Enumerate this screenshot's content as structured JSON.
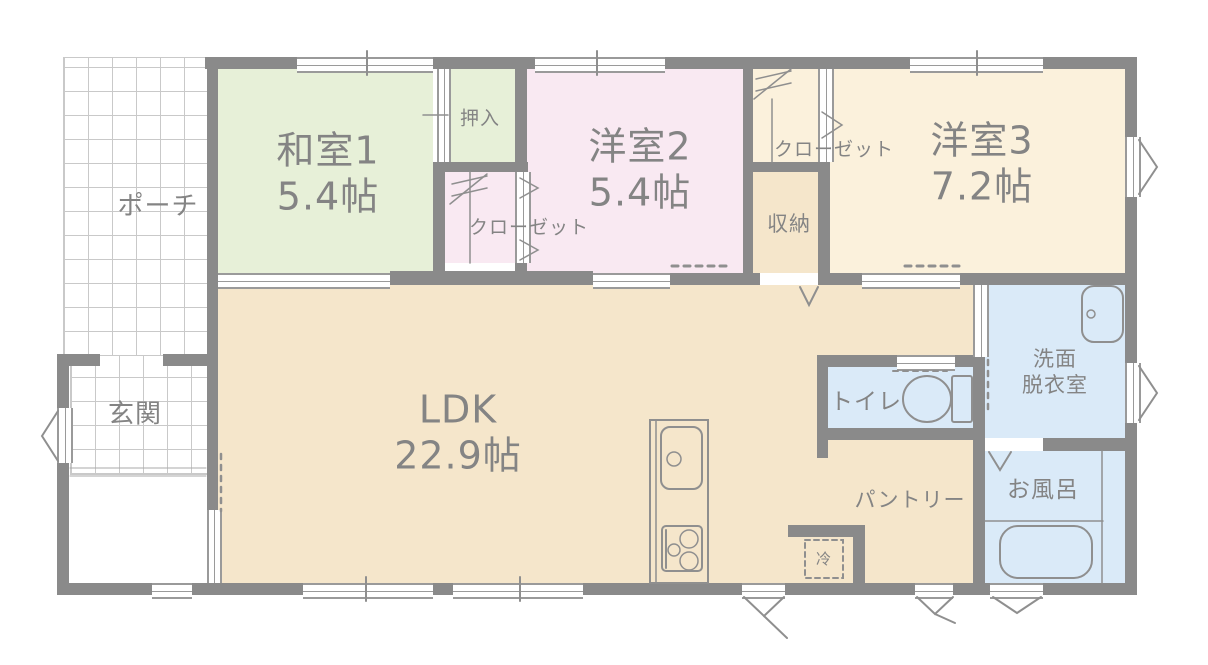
{
  "rooms": {
    "porch": {
      "label": "ポーチ"
    },
    "entrance": {
      "label": "玄関"
    },
    "japanese_room_1": {
      "label": "和室1",
      "size": "5.4帖"
    },
    "oshiire": {
      "label": "押入"
    },
    "closet_west": {
      "label": "クローゼット"
    },
    "western_room_2": {
      "label": "洋室2",
      "size": "5.4帖"
    },
    "closet_east": {
      "label": "クローゼット"
    },
    "storage": {
      "label": "収納"
    },
    "western_room_3": {
      "label": "洋室3",
      "size": "7.2帖"
    },
    "ldk": {
      "label": "LDK",
      "size": "22.9帖"
    },
    "toilet": {
      "label": "トイレ"
    },
    "washroom": {
      "label_line1": "洗面",
      "label_line2": "脱衣室"
    },
    "bath": {
      "label": "お風呂"
    },
    "pantry": {
      "label": "パントリー"
    },
    "refrigerator": {
      "label": "冷"
    }
  },
  "colors": {
    "wall": "#8a8a8a",
    "room_green": "#e7f0d8",
    "room_pink": "#f9e9f2",
    "room_cream": "#fbf1dc",
    "room_beige": "#f5e6cb",
    "room_blue": "#daeaf8",
    "label_text": "#848484",
    "grid_line": "#c9c9c9",
    "symbol_line": "#8f8f8f"
  },
  "icons": {
    "kitchen": "kitchen-sink-stove-icon",
    "toilet": "toilet-icon",
    "bathtub": "bathtub-icon",
    "vanity": "vanity-sink-icon"
  }
}
